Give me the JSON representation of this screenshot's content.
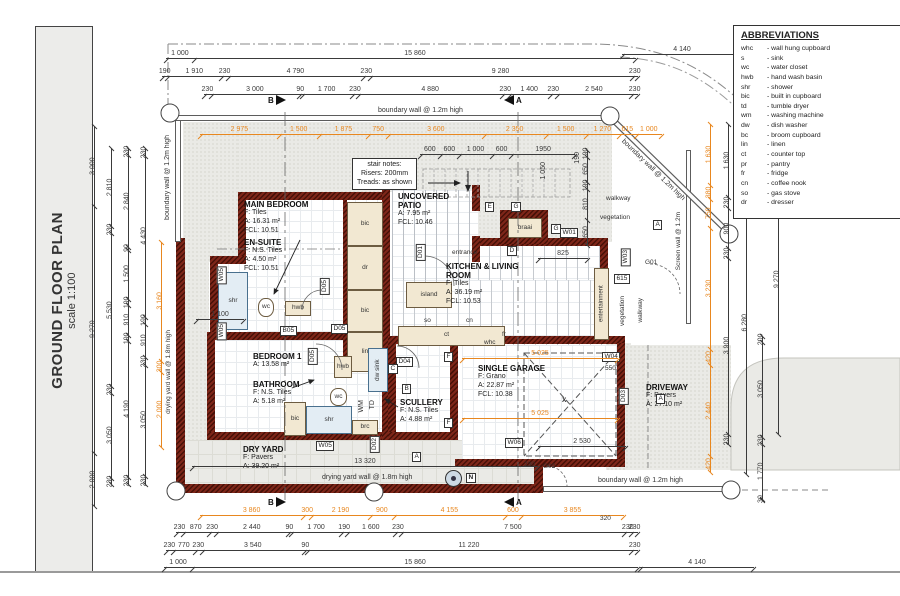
{
  "sheet": {
    "title": "GROUND FLOOR PLAN",
    "scale": "scale 1:100"
  },
  "abbreviations": {
    "title": "ABBREVIATIONS",
    "items": [
      {
        "abbr": "whc",
        "meaning": "- wall hung cupboard"
      },
      {
        "abbr": "s",
        "meaning": "- sink"
      },
      {
        "abbr": "wc",
        "meaning": "- water closet"
      },
      {
        "abbr": "hwb",
        "meaning": "- hand wash basin"
      },
      {
        "abbr": "shr",
        "meaning": "- shower"
      },
      {
        "abbr": "bic",
        "meaning": "- built in cupboard"
      },
      {
        "abbr": "td",
        "meaning": "- tumble dryer"
      },
      {
        "abbr": "wm",
        "meaning": "- washing machine"
      },
      {
        "abbr": "dw",
        "meaning": "- dish washer"
      },
      {
        "abbr": "bc",
        "meaning": "- broom cupboard"
      },
      {
        "abbr": "lin",
        "meaning": "- linen"
      },
      {
        "abbr": "ct",
        "meaning": "- counter top"
      },
      {
        "abbr": "pr",
        "meaning": "- pantry"
      },
      {
        "abbr": "fr",
        "meaning": "- fridge"
      },
      {
        "abbr": "cn",
        "meaning": "- coffee nook"
      },
      {
        "abbr": "so",
        "meaning": "- gas stove"
      },
      {
        "abbr": "dr",
        "meaning": "- dresser"
      }
    ]
  },
  "rooms": {
    "main_bedroom": {
      "name": "MAIN BEDROOM",
      "l1": "F: Tiles",
      "l2": "A: 16.31 m²",
      "l3": "FCL: 10.51"
    },
    "en_suite": {
      "name": "EN-SUITE",
      "l1": "F: N.S. Tiles",
      "l2": "A: 4.50 m²",
      "l3": "FCL: 10.51"
    },
    "bedroom1": {
      "name": "BEDROOM 1",
      "l1": "A: 13.58 m²"
    },
    "bathroom": {
      "name": "BATHROOM",
      "l1": "F: N.S. Tiles",
      "l2": "A: 5.18 m²"
    },
    "dry_yard": {
      "name": "DRY YARD",
      "l1": "F: Pavers",
      "l2": "A: 39.20 m²"
    },
    "scullery": {
      "name": "SCULLERY",
      "l1": "F: N.S. Tiles",
      "l2": "A: 4.88 m²"
    },
    "patio": {
      "name": "UNCOVERED PATIO",
      "l1": "A: 7.95 m²",
      "l2": "FCL: 10.46"
    },
    "kitchen": {
      "name": "KITCHEN & LIVING ROOM",
      "l1": "F: Tiles",
      "l2": "A: 36.19 m²",
      "l3": "FCL: 10.53"
    },
    "garage": {
      "name": "SINGLE GARAGE",
      "l1": "F: Grano",
      "l2": "A: 22.87 m²",
      "l3": "FCL: 10.38"
    },
    "driveway": {
      "name": "DRIVEWAY",
      "l1": "F: Pavers",
      "l2": "A: 27.10 m²"
    }
  },
  "stair_notes": {
    "l1": "stair notes:",
    "l2": "Risers: 200mm",
    "l3": "Treads: as shown"
  },
  "notes": {
    "boundary": "boundary wall @ 1.2m high",
    "drying": "drying yard wall @ 1.8m high",
    "screen": "Screen wall @ 1.2m"
  },
  "labels": {
    "walkway": "walkway",
    "vegetation": "vegetation",
    "entertainment": "entertainment",
    "entrance": "entrance",
    "island": "island",
    "braai": "braai"
  },
  "fx": {
    "bic": "bic",
    "dr": "dr",
    "lin": "lin",
    "shr": "shr",
    "wc": "wc",
    "hwb": "hwb",
    "brc": "brc",
    "wm": "WM",
    "td": "TD",
    "dwsink": "dw sink",
    "so": "so",
    "cn": "cn",
    "ct": "ct",
    "whc": "whc",
    "fr": "fr",
    "x": "X"
  },
  "op": {
    "w01": "W01",
    "w03": "W03",
    "w04": "W04",
    "w05": "W05",
    "w06": "W06",
    "d01": "D01",
    "d02": "D02",
    "d03": "D03",
    "d04": "D04",
    "d05": "D05",
    "b05": "B05",
    "g01": "G01",
    "g02": "G02"
  },
  "tags": {
    "a": "A",
    "b": "B",
    "c": "C",
    "d": "D",
    "e": "E",
    "f": "F",
    "g": "G"
  },
  "markers": {
    "north": "N",
    "sec_a": "A",
    "sec_b": "B"
  },
  "dims": {
    "top1": [
      "1 000",
      "15 860"
    ],
    "top2": [
      "190",
      "1 910",
      "230",
      "4 790",
      "230",
      "9 280",
      "230"
    ],
    "top3": [
      "230",
      "3 000",
      "90",
      "1 700",
      "230",
      "4 880",
      "230",
      "1 400",
      "230",
      "2 540",
      "230"
    ],
    "top_orange": [
      "2 975",
      "1 500",
      "1 875",
      "750",
      "3 600",
      "2 350",
      "1 500",
      "1 270",
      "615",
      "1 000"
    ],
    "stairs": [
      "600",
      "600",
      "1 000",
      "600",
      "1950"
    ],
    "patio_right": [
      "190",
      "650",
      "190",
      "810",
      "650"
    ],
    "bottom_orange": [
      "3 860",
      "300",
      "2 190",
      "900",
      "4 155",
      "600",
      "3 855"
    ],
    "bottom1": [
      "230",
      "870",
      "230",
      "2 440",
      "90",
      "1 700",
      "190",
      "1 600",
      "230",
      "7 500",
      "230",
      "230"
    ],
    "bottom2": [
      "230",
      "770",
      "230",
      "3 540",
      "90",
      "11 220",
      "230"
    ],
    "bottom3": [
      "1 000",
      "15 860"
    ],
    "left1": [
      "3 000",
      "9 270",
      "2 000"
    ],
    "left2": [
      "2 810",
      "230",
      "5 530",
      "230",
      "3 050",
      "230"
    ],
    "left3": [
      "230",
      "2 840",
      "90",
      "1 500",
      "190",
      "910",
      "190",
      "4 190",
      "230"
    ],
    "left4": [
      "230",
      "4 430",
      "190",
      "910",
      "230",
      "3 050",
      "230"
    ],
    "left_orange": [
      "3 160",
      "300",
      "2 000"
    ],
    "right_orange": [
      "1 630",
      "380",
      "750",
      "3 230",
      "420",
      "2 440",
      "420"
    ],
    "right1": [
      "1 630",
      "230",
      "900",
      "230",
      "3 900",
      "230"
    ],
    "right2": [
      "230",
      "620",
      "90",
      "6 280"
    ],
    "right3": [
      "200",
      "3 050",
      "230",
      "1 770",
      "30"
    ],
    "right4": [
      "9 270"
    ],
    "misc": {
      "d4140": "4 140",
      "d825": "825",
      "d615": "615",
      "d550": "550",
      "d2530": "2 530",
      "d320": "320",
      "d230": "230",
      "d1050": "1 050",
      "d190": "190",
      "d13320": "13 320",
      "d1100": "1 100",
      "d5025": "5 025"
    }
  },
  "colors": {
    "wall": "#7e2619",
    "dim_orange": "#e8871f",
    "dim_black": "#3a3a3a",
    "outdoor": "#eaeae6"
  }
}
